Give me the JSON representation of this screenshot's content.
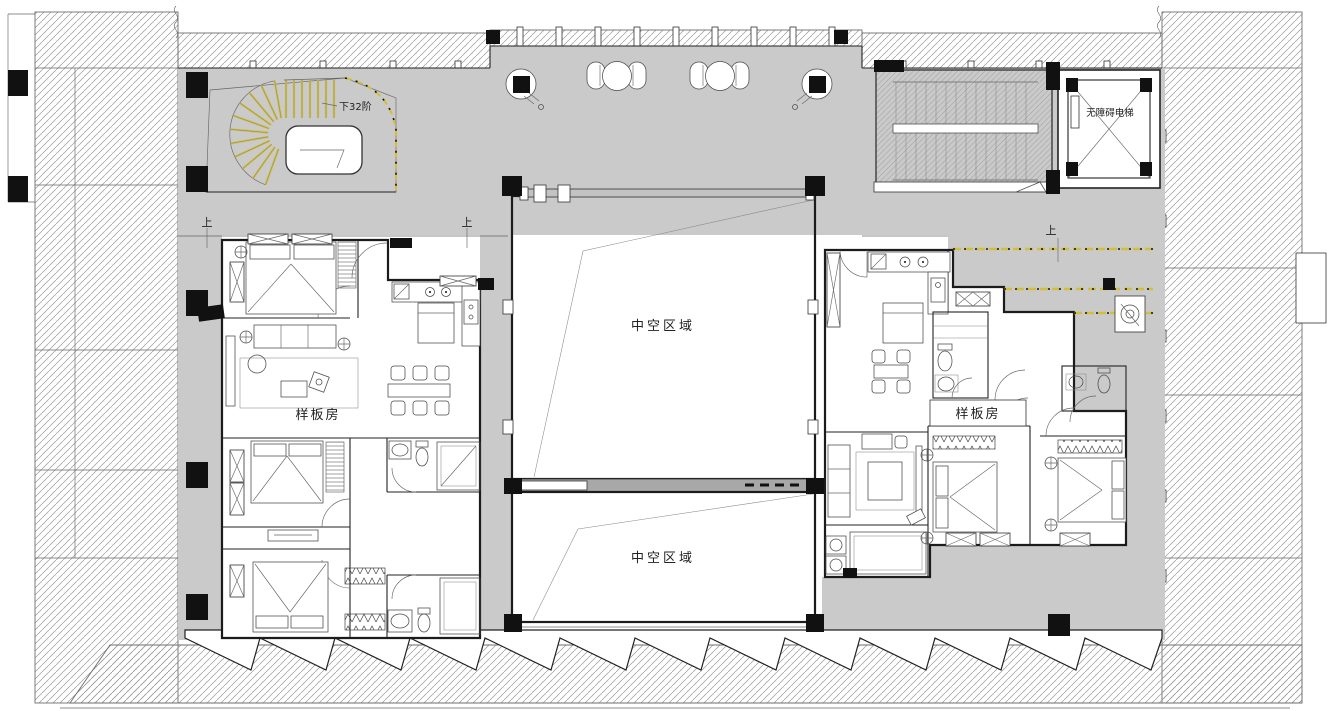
{
  "drawing": {
    "type": "architectural-floor-plan",
    "description": "Residential show-flat floor plan with central double-height void, spiral stair, accessible elevator and two model apartments"
  },
  "labels": {
    "stair_note": "下32阶",
    "elevator": "无障碍电梯",
    "atrium_upper": "中空区域",
    "atrium_lower": "中空区域",
    "model_room_left": "样板房",
    "model_room_right": "样板房",
    "up_marker_left": "上",
    "up_marker_center": "上",
    "up_marker_right": "上"
  },
  "colors": {
    "floor_gray": "#cacaca",
    "hatch_line": "#9a9a9a",
    "wall": "#1b1b1b",
    "stair_accent_yellow": "#d3bf3a"
  }
}
